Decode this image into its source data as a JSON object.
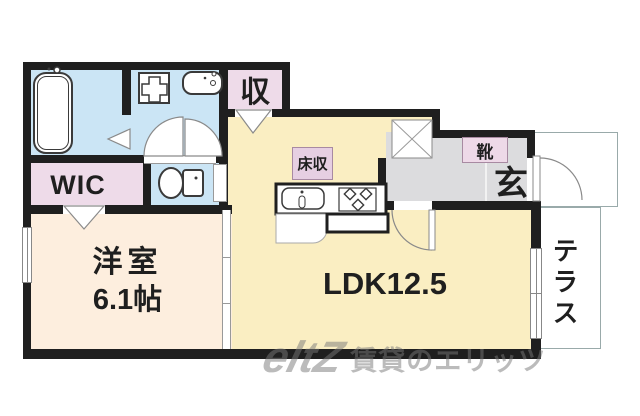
{
  "plan": {
    "rooms": {
      "wic": {
        "label": "WIC"
      },
      "western_room": {
        "label": "洋室",
        "size": "6.1帖"
      },
      "ldk": {
        "label": "LDK12.5"
      },
      "storage": {
        "label": "収"
      },
      "floor_storage": {
        "label": "床収"
      },
      "shoe_box": {
        "label": "靴"
      },
      "entrance": {
        "label": "玄"
      },
      "terrace": {
        "label": "テラス"
      }
    },
    "fixtures": [
      "bathtub-icon",
      "washing-machine-pan-icon",
      "washbasin-icon",
      "toilet-icon",
      "kitchen-sink-icon",
      "stove-icon",
      "pillar-x-icon",
      "entrance-door-icon",
      "ldk-hall-door-icon",
      "double-swing-door-icon"
    ],
    "watermark": {
      "logo": "eltZ",
      "text": "賃貸のエリッツ"
    },
    "colors": {
      "wall": "#1f1f1f",
      "wet_area_blue": "#cbe5f5",
      "closet_pink": "#eedbe9",
      "label_pink": "#e6cfe2",
      "western_room_floor": "#fdeede",
      "ldk_floor": "#faeec2",
      "entrance_gray": "#dcdcde"
    }
  }
}
